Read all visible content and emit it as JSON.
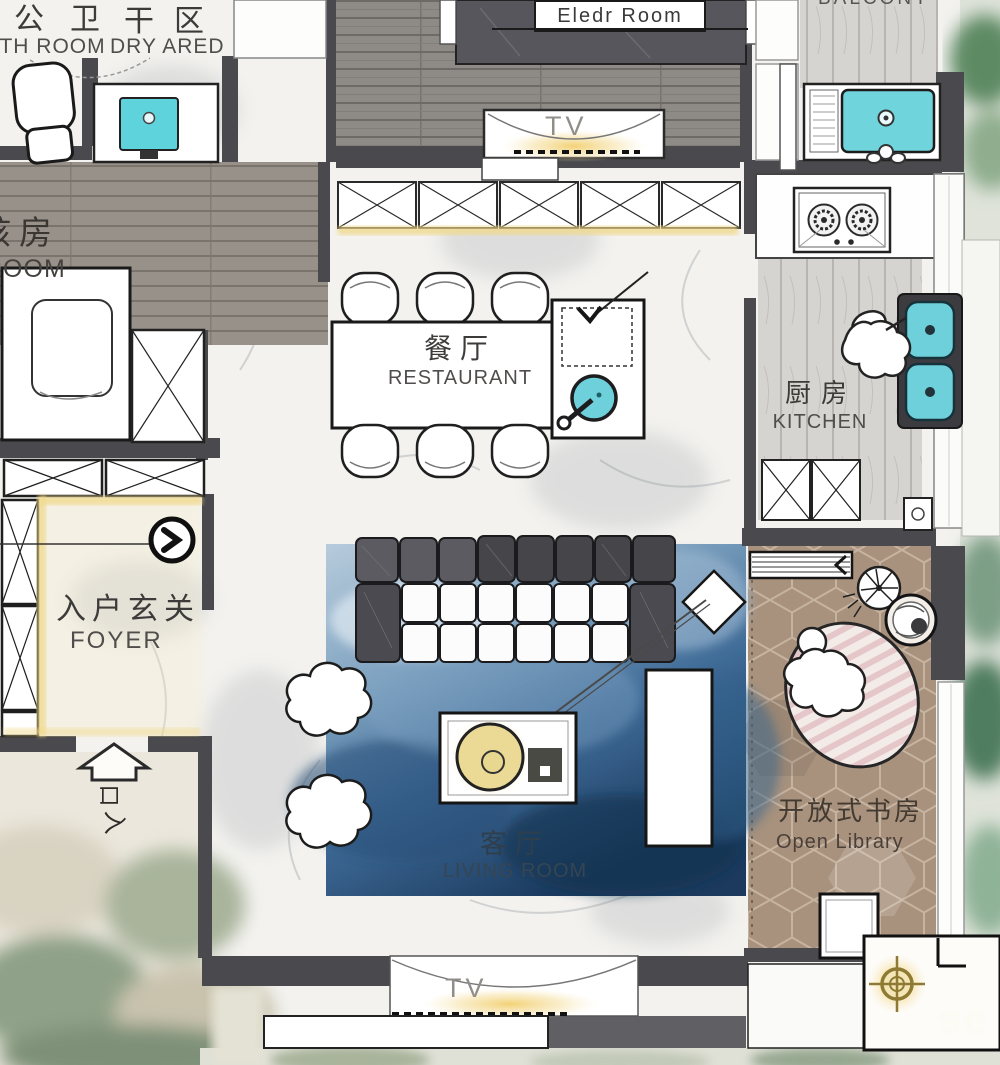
{
  "rooms": {
    "bath": {
      "zh": "公卫",
      "en": "ATH ROOM"
    },
    "dry_area": {
      "zh": "干区",
      "en": "DRY ARED"
    },
    "kids_room": {
      "zh": "孩房",
      "en": "ROOM"
    },
    "elder_room": {
      "en": "Eledr Room"
    },
    "balcony": {
      "en": "BALCONY"
    },
    "dining": {
      "zh": "餐厅",
      "en": "RESTAURANT"
    },
    "kitchen": {
      "zh": "厨房",
      "en": "KITCHEN"
    },
    "foyer": {
      "zh": "入户玄关",
      "en": "FOYER"
    },
    "living": {
      "zh": "客厅",
      "en": "LIVING ROOM"
    },
    "library": {
      "zh": "开放式书房",
      "en": "Open Library"
    }
  },
  "labels": {
    "tv_master": "TV",
    "tv_living": "TV",
    "entry_top": "口",
    "entry_bottom": "入"
  },
  "watermark": "se",
  "colors": {
    "wall": "#4a4a4e",
    "accent_cyan": "#6ed0da",
    "accent_yellow": "#f1d98b",
    "rug_blue": "#3f6b97",
    "rug_pink_stripe": "#e0b9be",
    "library_floor": "#a8927e",
    "label_text": "#3d3b39"
  }
}
